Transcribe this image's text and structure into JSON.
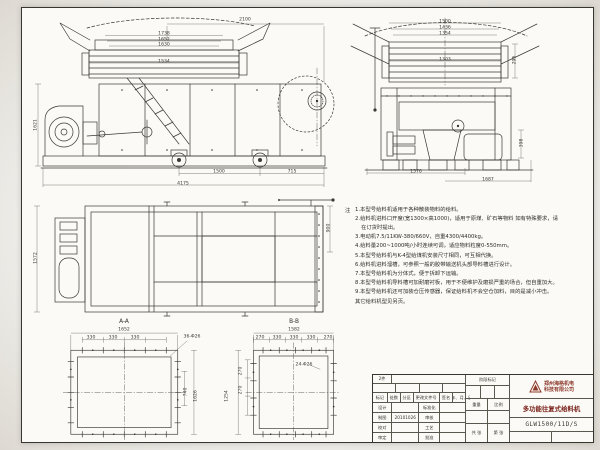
{
  "sheet": {
    "paper_color": "#fbfaf6",
    "line_color": "#3b3933",
    "accent_red": "#8d3a2c"
  },
  "views": {
    "side": {
      "dims": [
        {
          "t": "2100",
          "x": 218,
          "y": 11
        },
        {
          "t": "1738",
          "x": 137,
          "y": 25
        },
        {
          "t": "1652",
          "x": 137,
          "y": 31
        },
        {
          "t": "1630",
          "x": 137,
          "y": 36
        },
        {
          "t": "1534",
          "x": 137,
          "y": 53
        },
        {
          "t": "1621",
          "x": 10,
          "y": 115,
          "r": -90
        },
        {
          "t": "1500",
          "x": 192,
          "y": 163
        },
        {
          "t": "715",
          "x": 265,
          "y": 163
        },
        {
          "t": "4175",
          "x": 156,
          "y": 175
        }
      ]
    },
    "end": {
      "dims": [
        {
          "t": "1500",
          "x": 108,
          "y": 13
        },
        {
          "t": "1436",
          "x": 108,
          "y": 19
        },
        {
          "t": "1354",
          "x": 108,
          "y": 25
        },
        {
          "t": "1303",
          "x": 108,
          "y": 51
        },
        {
          "t": "295",
          "x": 179,
          "y": 50,
          "r": -90
        },
        {
          "t": "398",
          "x": 186,
          "y": 133,
          "r": -90
        },
        {
          "t": "1576",
          "x": 79,
          "y": 163
        },
        {
          "t": "1687",
          "x": 151,
          "y": 171
        }
      ]
    },
    "plan": {
      "dims": [
        {
          "t": "1572",
          "x": 10,
          "y": 64,
          "r": -90
        },
        {
          "t": "900",
          "x": 303,
          "y": 34,
          "r": -90
        }
      ]
    },
    "aa": {
      "label": "A-A",
      "dims": [
        {
          "t": "1652",
          "x": 84,
          "y": 17
        },
        {
          "t": "330",
          "x": 51,
          "y": 25
        },
        {
          "t": "330",
          "x": 73,
          "y": 25
        },
        {
          "t": "330",
          "x": 95,
          "y": 25
        },
        {
          "t": "36-Φ26",
          "x": 152,
          "y": 24
        },
        {
          "t": "740",
          "x": 147,
          "y": 78,
          "r": -90
        },
        {
          "t": "1626",
          "x": 157,
          "y": 82,
          "r": -90
        }
      ]
    },
    "bb": {
      "label": "B-B",
      "dims": [
        {
          "t": "1582",
          "x": 72,
          "y": 17
        },
        {
          "t": "270",
          "x": 38,
          "y": 25
        },
        {
          "t": "330",
          "x": 55,
          "y": 25
        },
        {
          "t": "330",
          "x": 72,
          "y": 25
        },
        {
          "t": "330",
          "x": 89,
          "y": 25
        },
        {
          "t": "270",
          "x": 106,
          "y": 25
        },
        {
          "t": "24-Φ26",
          "x": 82,
          "y": 52
        },
        {
          "t": "270",
          "x": 20,
          "y": 57,
          "r": -90
        },
        {
          "t": "270",
          "x": 20,
          "y": 76,
          "r": -90
        },
        {
          "t": "1254",
          "x": 6,
          "y": 82,
          "r": -90
        }
      ]
    }
  },
  "notes": {
    "marker": "注",
    "items": [
      "1.本型号给料机适用于各种散装物料的给料。",
      "2.给料机进料口开度(宽1300×高1000)，适用于原煤、矿石等物料 如有特殊要求，请在订货时提出。",
      "3.电动机7.5/11KW-380/660V，自重4300/4400kg。",
      "4.给料量200~1000吨/小时连续可调，适应物料粒度0-550mm。",
      "5.本型号给料机与K-4型给煤机安装尺寸相同，可互相代换。",
      "6.给料机进料溜槽，可参照一般的胶带输送机头部导料槽进行设计。",
      "7.本型号给料机为分体式，便于拆卸下运输。",
      "8.本型号给料机导料槽可加耐磨衬板，用于不便维护及磨损严重的场合，但自重加大。",
      "9.本型号给料机还可加装仓压传感器，保证给料机不会空仓加料，目的是减小冲击。",
      "其它给料机型见另页。"
    ]
  },
  "titleblock": {
    "corner_note": "2件",
    "rev_headers": [
      "标记",
      "处数",
      "分区",
      "更改文件号",
      "签名",
      "年、月、日"
    ],
    "sig_rows": [
      [
        "设计",
        "",
        "标准化",
        ""
      ],
      [
        "制图",
        "20101026",
        "审核",
        ""
      ],
      [
        "校对",
        "",
        "工艺",
        ""
      ],
      [
        "审定",
        "",
        "批准",
        ""
      ]
    ],
    "stage_label": "阶段标记",
    "weight_label": "重量",
    "scale_label": "比例",
    "sheets_label": "共 张",
    "page_label": "第 张",
    "company_line1": "郑州海格机电",
    "company_line2": "科技有限公司",
    "product_title": "多功能往复式给料机",
    "drawing_no": "GLW1500/11D/S"
  }
}
